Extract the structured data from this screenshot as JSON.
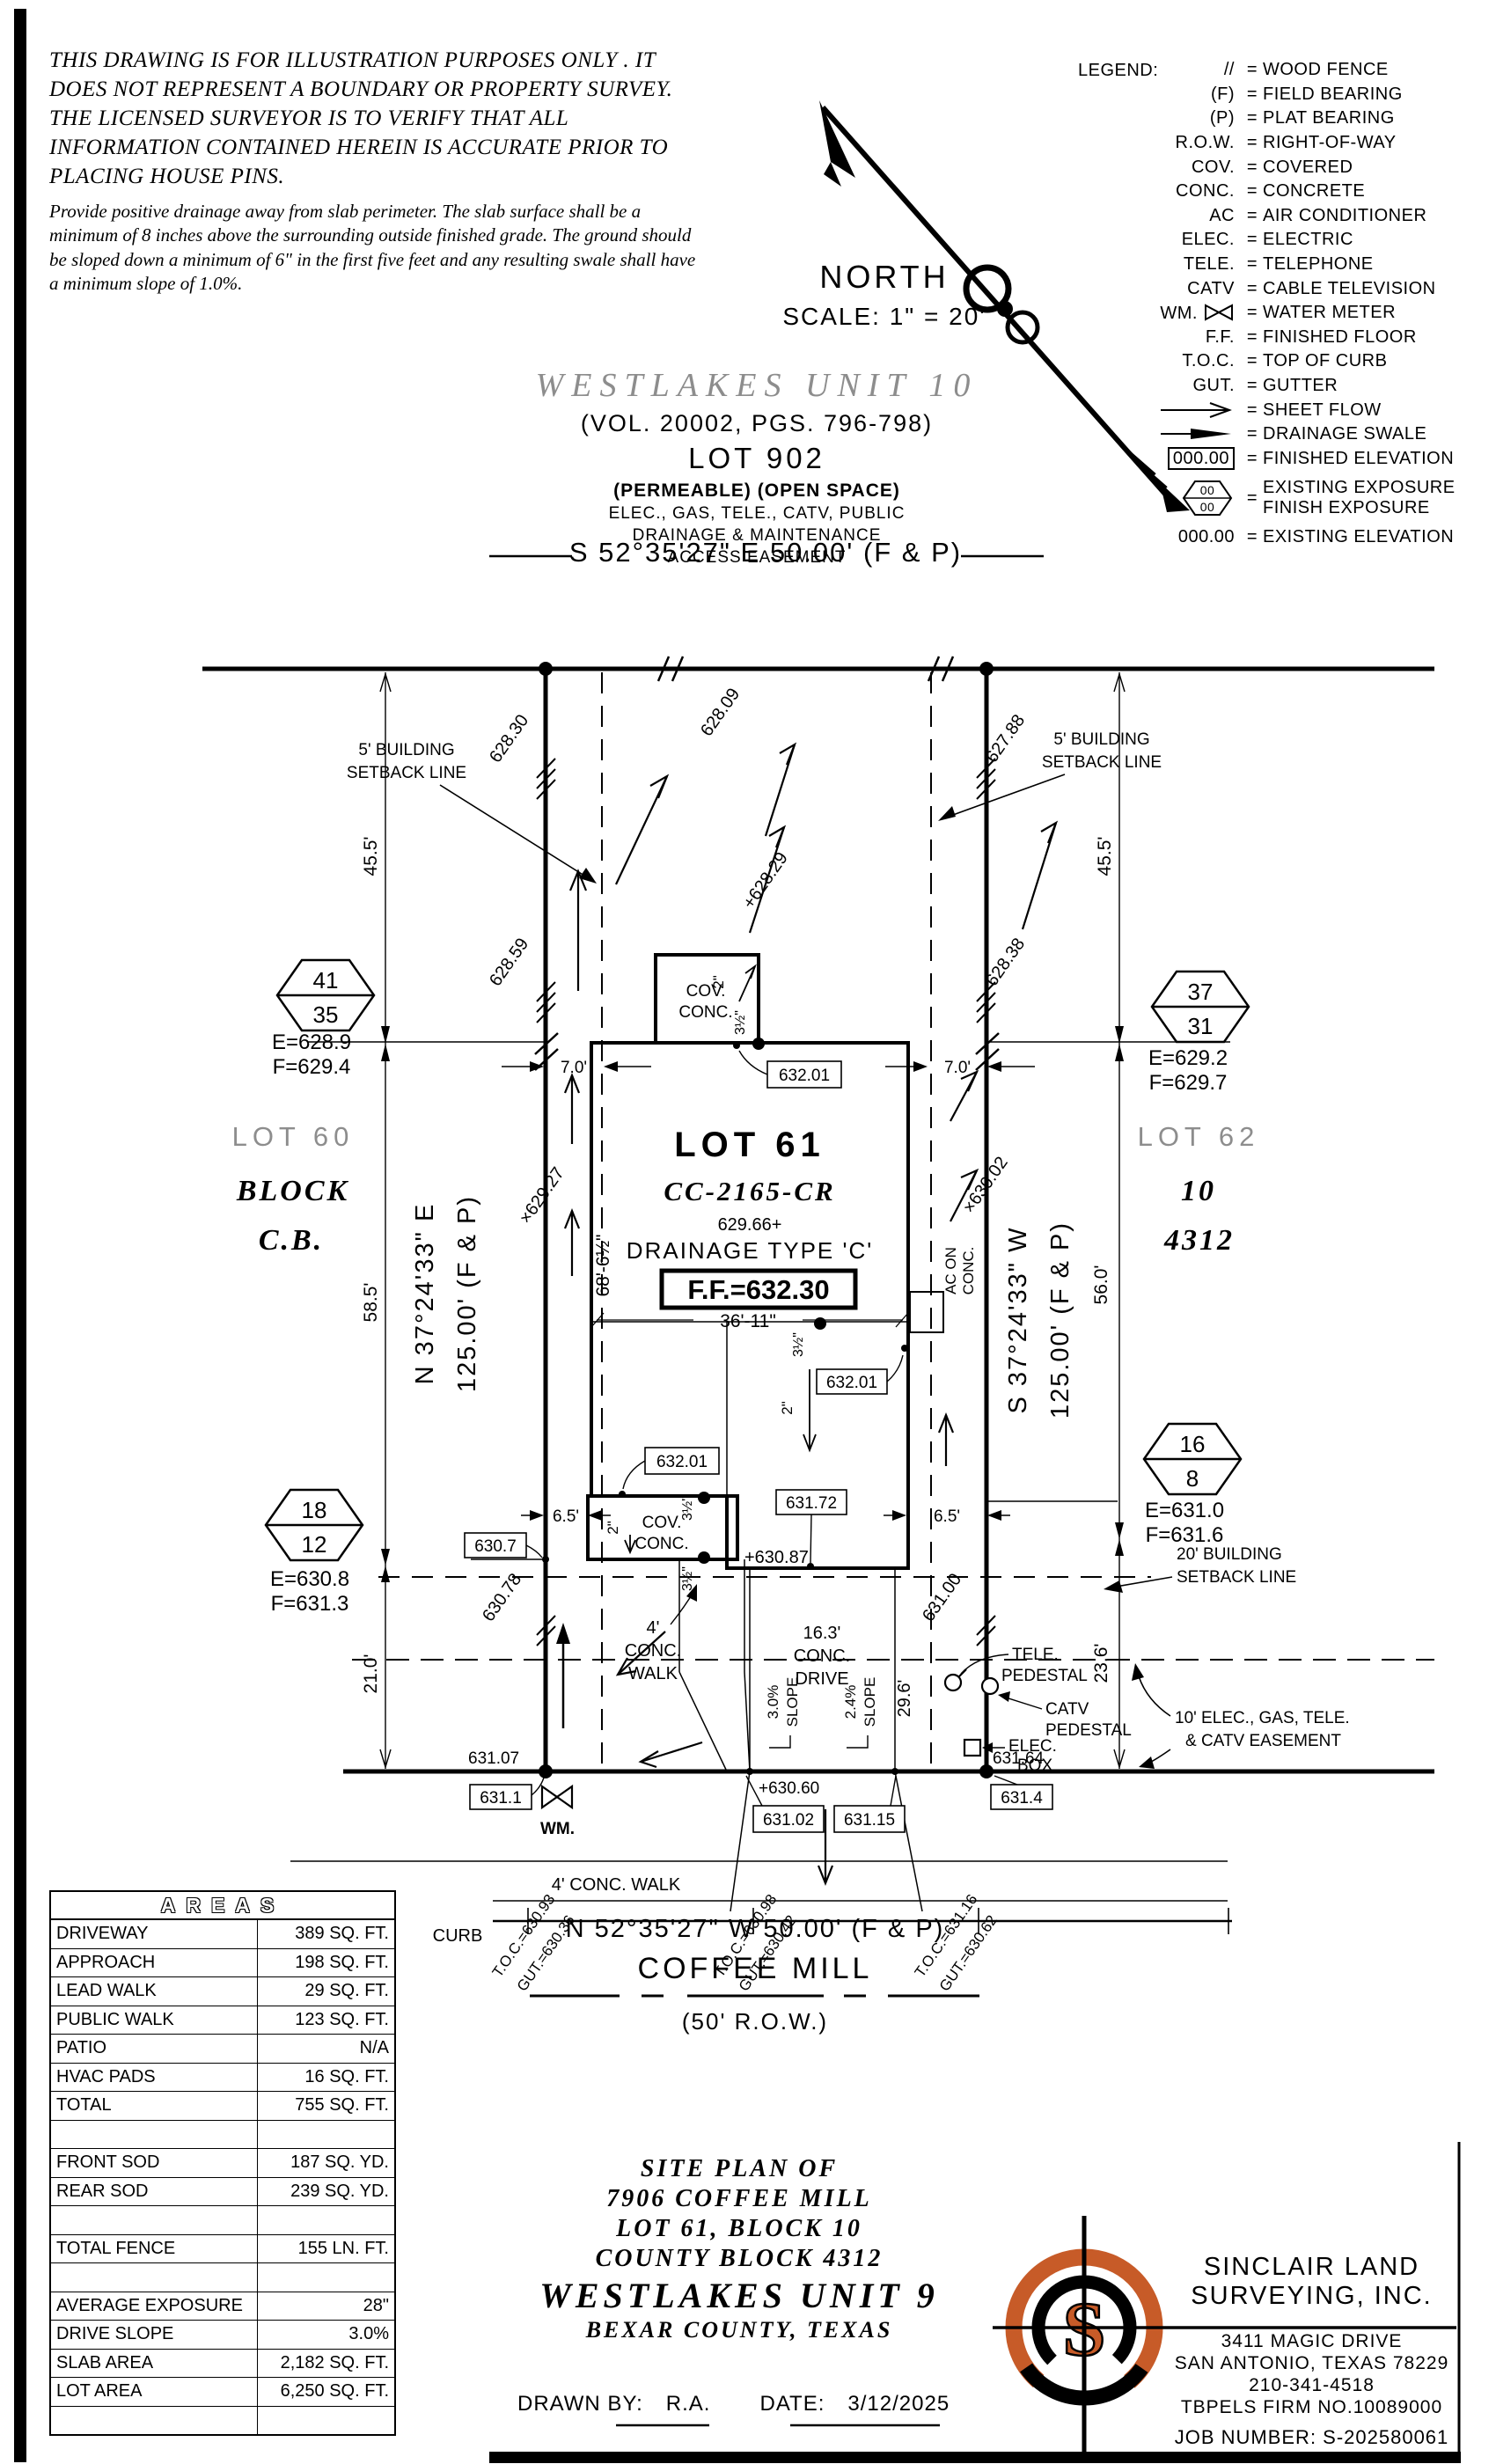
{
  "colors": {
    "accent": "#C75B28",
    "muted": "#8d8d8d",
    "line": "#000000"
  },
  "disclaimer": {
    "p1": "THIS DRAWING IS FOR ILLUSTRATION PURPOSES ONLY . IT DOES NOT REPRESENT A BOUNDARY OR PROPERTY SURVEY. THE LICENSED SURVEYOR IS TO VERIFY THAT ALL INFORMATION CONTAINED HEREIN IS ACCURATE PRIOR TO PLACING HOUSE PINS.",
    "p2": "Provide positive drainage away from slab perimeter. The slab surface shall be a minimum of 8 inches above the surrounding outside finished grade. The ground should be sloped down a minimum of 6\" in the first five feet and any resulting swale shall have a minimum slope of 1.0%."
  },
  "north": {
    "label": "NORTH",
    "scale": "SCALE: 1\" = 20'"
  },
  "legend": {
    "title": "LEGEND:",
    "eq": "=",
    "rows": [
      {
        "sym": "//",
        "label": "WOOD FENCE"
      },
      {
        "sym": "(F)",
        "label": "FIELD BEARING"
      },
      {
        "sym": "(P)",
        "label": "PLAT BEARING"
      },
      {
        "sym": "R.O.W.",
        "label": "RIGHT-OF-WAY"
      },
      {
        "sym": "COV.",
        "label": "COVERED"
      },
      {
        "sym": "CONC.",
        "label": "CONCRETE"
      },
      {
        "sym": "AC",
        "label": "AIR CONDITIONER"
      },
      {
        "sym": "ELEC.",
        "label": "ELECTRIC"
      },
      {
        "sym": "TELE.",
        "label": "TELEPHONE"
      },
      {
        "sym": "CATV",
        "label": "CABLE TELEVISION"
      },
      {
        "sym": "WM.",
        "label": "WATER METER"
      },
      {
        "sym": "F.F.",
        "label": "FINISHED FLOOR"
      },
      {
        "sym": "T.O.C.",
        "label": "TOP OF CURB"
      },
      {
        "sym": "GUT.",
        "label": "GUTTER"
      },
      {
        "sym": "",
        "label": "SHEET FLOW"
      },
      {
        "sym": "",
        "label": "DRAINAGE SWALE"
      },
      {
        "sym": "000.00",
        "label": "FINISHED ELEVATION"
      },
      {
        "sym1": "00",
        "sym2": "00",
        "label": "EXISTING EXPOSURE",
        "label2": "FINISH EXPOSURE"
      },
      {
        "sym": "000.00",
        "label": "EXISTING ELEVATION"
      }
    ]
  },
  "subdivision": {
    "name": "WESTLAKES UNIT 10",
    "vol": "(VOL. 20002, PGS. 796-798)",
    "lot": "LOT 902",
    "use": "(PERMEABLE) (OPEN SPACE)",
    "e1": "ELEC., GAS, TELE., CATV, PUBLIC",
    "e2": "DRAINAGE & MAINTENANCE",
    "e3": "ACCESS EASEMENT"
  },
  "bearing": {
    "top": "S 52°35'27\" E 50.00' (F & P)",
    "bottom": "N 52°35'27\" W 50.00' (F & P)",
    "west1": "N 37°24'33\" E",
    "west2": "125.00' (F & P)",
    "east1": "S 37°24'33\" W",
    "east2": "125.00' (F & P)"
  },
  "street": {
    "name": "COFFEE MILL",
    "row": "(50' R.O.W.)"
  },
  "adj": {
    "l1": "LOT 60",
    "l2": "BLOCK",
    "l3": "C.B.",
    "r1": "LOT 62",
    "r2": "10",
    "r3": "4312"
  },
  "hex": {
    "nw1": "41",
    "nw2": "35",
    "nwe": "E=628.9",
    "nwf": "F=629.4",
    "ne1": "37",
    "ne2": "31",
    "nee": "E=629.2",
    "nef": "F=629.7",
    "sw1": "18",
    "sw2": "12",
    "swe": "E=630.8",
    "swf": "F=631.3",
    "se1": "16",
    "se2": "8",
    "see": "E=631.0",
    "sef": "F=631.6"
  },
  "labels": {
    "sb1": "5' BUILDING",
    "sb2": "SETBACK LINE",
    "fsb1": "20' BUILDING",
    "fsb2": "SETBACK LINE",
    "ease1": "10' ELEC., GAS, TELE.",
    "ease2": "& CATV EASEMENT",
    "tele1": "TELE.",
    "tele2": "PEDESTAL",
    "catv1": "CATV",
    "catv2": "PEDESTAL",
    "elec1": "ELEC.",
    "elec2": "BOX",
    "wm": "WM.",
    "curb": "CURB",
    "pwalk": "4' CONC. WALK",
    "lw1": "4'",
    "lw2": "CONC.",
    "lw3": "WALK",
    "dr1": "16.3'",
    "dr2": "CONC.",
    "dr3": "DRIVE",
    "sl1a": "3.0%",
    "sl1b": "SLOPE",
    "sl2a": "2.4%",
    "sl2b": "SLOPE"
  },
  "house": {
    "lot": "LOT 61",
    "model": "CC-2165-CR",
    "pad": "629.66+",
    "dtype": "DRAINAGE TYPE 'C'",
    "ff": "F.F.=632.30",
    "cov1": "COV.",
    "cov2": "CONC.",
    "ac1": "AC ON",
    "ac2": "CONC."
  },
  "dims": {
    "a": "45.5'",
    "b": "58.5'",
    "c": "56.0'",
    "e": "21.0'",
    "f": "23.6'",
    "g": "29.6'",
    "h": "7.0'",
    "i": "6.5'",
    "j": "68'-6½\"",
    "k": "36'-11\"",
    "l": "2\"",
    "m": "3½\""
  },
  "spot": {
    "s1": "628.30",
    "s2": "628.59",
    "s3": "×629.27",
    "s4": "630.78",
    "s5": "628.09",
    "s6": "+628.29",
    "s7": "627.88",
    "s8": "628.38",
    "s9": "×630.02",
    "s10": "631.00",
    "s11": "+630.87",
    "s12": "+630.60",
    "s13": "631.07",
    "s14": "631.64"
  },
  "ebox": {
    "b1": "632.01",
    "b2": "631.72",
    "b3": "630.7",
    "b4": "631.1",
    "b5": "631.02",
    "b6": "631.15",
    "b7": "631.4"
  },
  "toc": {
    "g1a": "T.O.C.=630.93",
    "g1b": "GUT.=630.36",
    "g2a": "T.O.C.=630.98",
    "g2b": "GUT.=630.42",
    "g3a": "T.O.C.=631.16",
    "g3b": "GUT.=630.62"
  },
  "areas": {
    "title": "AREAS",
    "rows": [
      {
        "label": "DRIVEWAY",
        "value": "389 SQ. FT."
      },
      {
        "label": "APPROACH",
        "value": "198 SQ. FT."
      },
      {
        "label": "LEAD WALK",
        "value": "29 SQ. FT."
      },
      {
        "label": "PUBLIC WALK",
        "value": "123 SQ. FT."
      },
      {
        "label": "PATIO",
        "value": "N/A"
      },
      {
        "label": "HVAC PADS",
        "value": "16 SQ. FT."
      },
      {
        "label": "TOTAL",
        "value": "755 SQ. FT."
      },
      {
        "label": "",
        "value": ""
      },
      {
        "label": "FRONT SOD",
        "value": "187 SQ. YD."
      },
      {
        "label": "REAR SOD",
        "value": "239 SQ. YD."
      },
      {
        "label": "",
        "value": ""
      },
      {
        "label": "TOTAL FENCE",
        "value": "155 LN. FT."
      },
      {
        "label": "",
        "value": ""
      },
      {
        "label": "AVERAGE EXPOSURE",
        "value": "28\""
      },
      {
        "label": "DRIVE SLOPE",
        "value": "3.0%"
      },
      {
        "label": "SLAB AREA",
        "value": "2,182 SQ. FT."
      },
      {
        "label": "LOT AREA",
        "value": "6,250 SQ. FT."
      },
      {
        "label": "",
        "value": ""
      }
    ]
  },
  "tblock": {
    "t1": "SITE PLAN OF",
    "t2": "7906 COFFEE MILL",
    "t3": "LOT 61, BLOCK 10",
    "t4": "COUNTY BLOCK 4312",
    "t5": "WESTLAKES UNIT 9",
    "t6": "BEXAR COUNTY, TEXAS",
    "drawn": "DRAWN BY:",
    "drawn_val": "R.A.",
    "date": "DATE:",
    "date_val": "3/12/2025"
  },
  "company": {
    "n1": "SINCLAIR LAND",
    "n2": "SURVEYING, INC.",
    "a1": "3411 MAGIC DRIVE",
    "a2": "SAN ANTONIO, TEXAS 78229",
    "a3": "210-341-4518",
    "a4": "TBPELS FIRM NO.10089000",
    "job": "JOB NUMBER: S-202580061",
    "initial": "S"
  }
}
